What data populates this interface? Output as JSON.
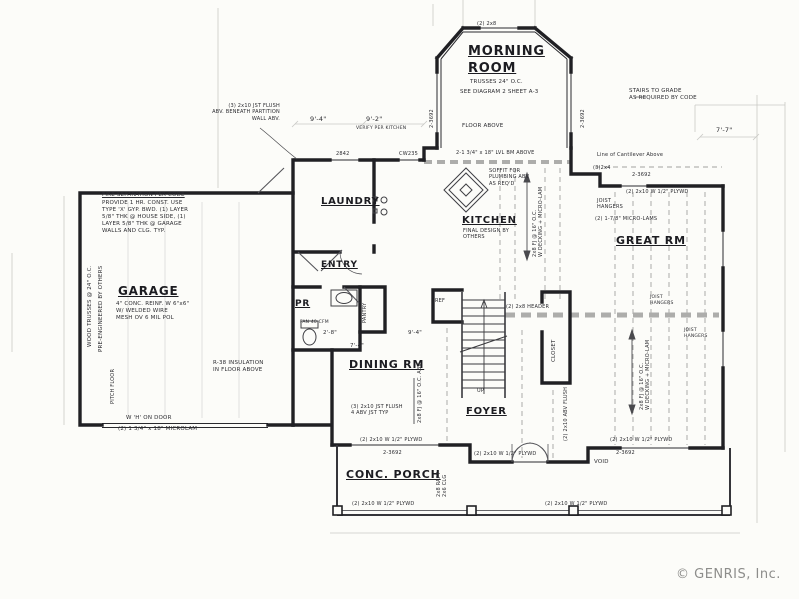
{
  "copyright": "© GENRIS, Inc.",
  "rooms": {
    "morning1": "MORNING",
    "morning2": "ROOM",
    "laundry": "LAUNDRY",
    "kitchen": "KITCHEN",
    "great": "GREAT RM",
    "garage": "GARAGE",
    "entry": "ENTRY",
    "pr": "PR",
    "pantry": "PANTRY",
    "dining": "DINING RM",
    "foyer": "FOYER",
    "closet": "CLOSET",
    "porch": "CONC. PORCH"
  },
  "notes": {
    "trusses": "TRUSSES 24\" O.C.",
    "see_diagram": "SEE DIAGRAM 2 SHEET A-3",
    "floor_above": "FLOOR ABOVE",
    "bay_header": "(2) 2x8",
    "verify": "VERIFY PER KITCHEN",
    "jst_flush_partition": "(3) 2x10 JST FLUSH\nABV. BENEATH PARTITION\nWALL ABV.",
    "lvl_beam": "2-1 3/4\" x 18\" LVL BM ABOVE",
    "soffit": "SOFFIT FOR\nPLUMBING ABV\nAS REQ'D",
    "kitchen_sub": "FINAL DESIGN BY\nOTHERS",
    "fj_decking": "2x8 FJ @ 16\" O.C.\nW DECKING + MICRO-LAM",
    "fj_abv": "2x8 FJ @ 16\" O.C. ABV",
    "stairs_grade": "STAIRS TO GRADE\nAS REQUIRED BY CODE",
    "cantilever": "Line of Cantilever Above",
    "l324": "(3)2x4",
    "plywd": "(2) 2x10 W 1/2\" PLYWD",
    "joist_hangers": "JOIST\nHANGERS",
    "microlams": "(2) 1-7/8\" MICRO-LAMS",
    "header28": "(2) 2x8 HEADER",
    "fire_title": "FIRE SEPARATION PER CODE",
    "fire_body": "PROVIDE 1 HR. CONST. USE\nTYPE 'X' GYP. BWD. (1) LAYER\n5/8\" THK @ HOUSE SIDE, (1)\nLAYER 5/8\" THK @ GARAGE\nWALLS AND CLG. TYP.",
    "wood_trusses": "WOOD TRUSSES @ 24\" O.C.",
    "pre_eng": "PRE-ENGINEERED BY OTHERS",
    "garage_sub": "4\" CONC. REINF. W 6\"x6\"\nW/ WELDED WIRE\nMESH OV 6 MIL POL",
    "pitch_floor": "PITCH FLOOR",
    "r38": "R-38 INSULATION\nIN FLOOR ABOVE",
    "h_door": "W 'H' ON DOOR",
    "microlam_hdr": "(2) 1 3/4\" x 18\" MICROLAM",
    "fan": "FAN 40 CFM",
    "ref": "REF",
    "jst_flush_dining": "(3) 2x10 JST FLUSH\n4 ABV JST TYP",
    "abv_flush": "(2) 2x10 ABV FLUSH",
    "up": "UP",
    "void": "VOID",
    "raft": "2x8 RAFT\n2x6 CLG",
    "w2842": "2842",
    "cw235": "CW235",
    "w3692": "2-3692"
  },
  "dims": {
    "d94": "9'-4\"",
    "d92": "9'-2\"",
    "d77": "7'-7\"",
    "d28": "2'-8\"",
    "d74": "7'-4\""
  }
}
